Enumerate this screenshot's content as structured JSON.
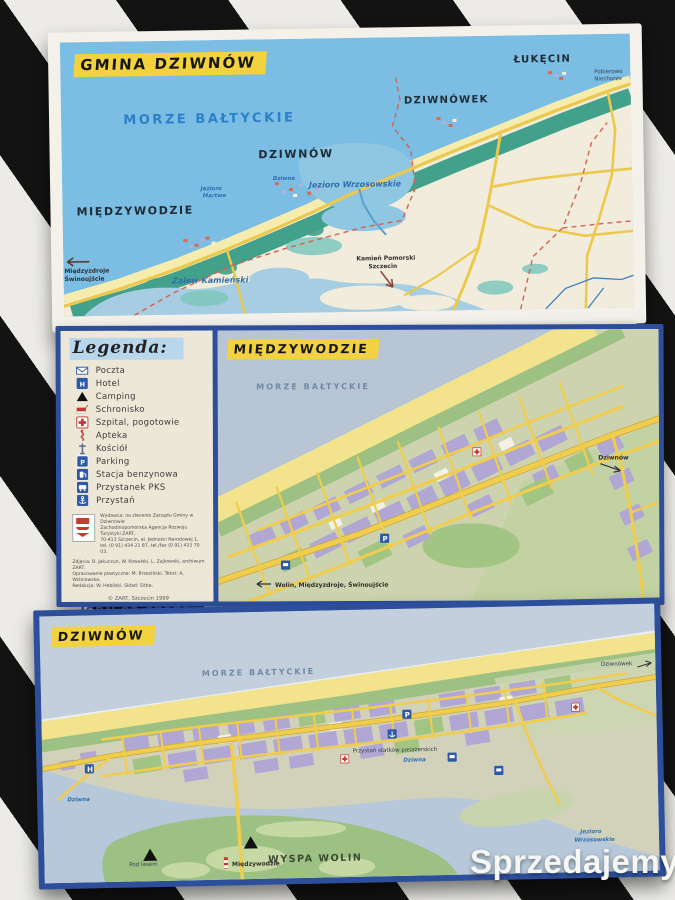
{
  "watermark": {
    "text": "Sprzedajemy",
    "badge": ".pl"
  },
  "colors": {
    "frame_navy": "#2d4f9b",
    "highlight_yellow": "#f2d23e",
    "watermark_orange": "#f0790a",
    "sea_blue": "#7cbde4",
    "road_yellow": "#f0cd4c"
  },
  "overview_map": {
    "title": "GMINA DZIWNÓW",
    "sea_label": "MORZE BAŁTYCKIE",
    "towns": {
      "miedzywodzie": "MIĘDZYWODZIE",
      "dziwnow": "DZIWNÓW",
      "dziwnowek": "DZIWNÓWEK",
      "lukecin": "ŁUKĘCIN"
    },
    "water_labels": {
      "lake": "Jezioro Wrzosowskie",
      "lagoon": "Zalew Kamieński",
      "dead_lake_l1": "Jezioro",
      "dead_lake_l2": "Martwe",
      "river": "Dziwna"
    },
    "directions": {
      "west_l1": "Międzyzdroje",
      "west_l2": "Świnoujście",
      "south_l1": "Kamień Pomorski",
      "south_l2": "Szczecin",
      "east_l1": "Pobierowo",
      "east_l2": "Niechorze"
    }
  },
  "legend": {
    "title": "Legenda:",
    "items": [
      {
        "icon": "post-icon",
        "label": "Poczta"
      },
      {
        "icon": "hotel-icon",
        "label": "Hotel",
        "glyph": "H"
      },
      {
        "icon": "camping-icon",
        "label": "Camping"
      },
      {
        "icon": "shelter-icon",
        "label": "Schronisko"
      },
      {
        "icon": "hospital-icon",
        "label": "Szpital, pogotowie"
      },
      {
        "icon": "pharmacy-icon",
        "label": "Apteka"
      },
      {
        "icon": "church-icon",
        "label": "Kościół"
      },
      {
        "icon": "parking-icon",
        "label": "Parking",
        "glyph": "P"
      },
      {
        "icon": "fuel-icon",
        "label": "Stacja benzynowa"
      },
      {
        "icon": "bus-stop-icon",
        "label": "Przystanek PKS"
      },
      {
        "icon": "marina-icon",
        "label": "Przystań"
      }
    ],
    "publisher_lines": [
      "Wydawca: na zlecenie Zarządu Gminy w Dziwnowie",
      "Zachodniopomorska Agencja Rozwoju Turystyki ZART,",
      "70-413 Szczecin, al. Jedności Narodowej 1,",
      "tel. (0 91) 434 21 87, tel./fax (0 91) 433 70 03."
    ],
    "credit_lines": [
      "Zdjęcia: B. Jakuczun, W. Kowalski, L. Zajkowski, archiwum ZART.",
      "Opracowanie plastyczne: M. Brzeziński. Tekst: A. Wiśniowska.",
      "Redakcja: W. Hebliski. Skład: Sitba."
    ],
    "copyright": "© ZART, Szczecin 1999",
    "isbn": "ISBN 83-87978-02-7"
  },
  "miedzywodzie_map": {
    "title": "MIĘDZYWODZIE",
    "sea_label": "MORZE BAŁTYCKIE",
    "dir_right": "Dziwnów",
    "dir_bottom": "Wolin, Międzyzdroje, Świnoujście"
  },
  "dziwnow_map": {
    "title": "DZIWNÓW",
    "sea_label": "MORZE BAŁTYCKIE",
    "island": "WYSPA WOLIN",
    "river": "Dziwna",
    "lake_l1": "Jezioro",
    "lake_l2": "Wrzosowskie",
    "marina": "Przystań statków pasażerskich",
    "dir_bottom": "Międzywodzie",
    "dir_right": "Dziwnówek",
    "camp": "Pod lasem"
  },
  "glyphs": {
    "hotel": "H",
    "parking": "P"
  }
}
